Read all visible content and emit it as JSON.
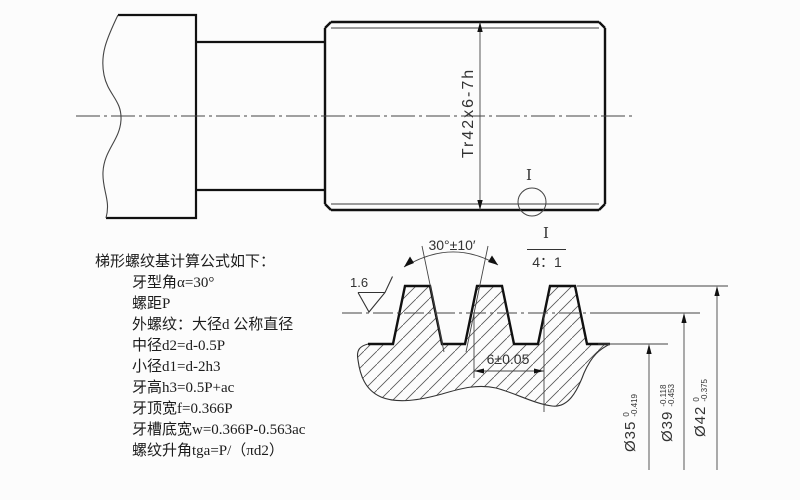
{
  "formulas": {
    "title": "梯形螺纹基计算公式如下：",
    "lines": [
      "牙型角α=30°",
      "螺距P",
      "外螺纹：大径d 公称直径",
      "中径d2=d-0.5P",
      "小径d1=d-2h3",
      "牙高h3=0.5P+ac",
      "牙顶宽f=0.366P",
      "牙槽底宽w=0.366P-0.563ac",
      "螺纹升角tga=P/（πd2）"
    ]
  },
  "main_view": {
    "thread_spec": "Tr42x6-7h",
    "detail_marker": "I"
  },
  "detail_view": {
    "detail_label": "I",
    "detail_scale": "4：1",
    "angle_dim": "30°±10′",
    "roughness": "1.6",
    "pitch_dim": "6±0.05",
    "diameters": [
      {
        "label": "Ø35",
        "upper_tol": "0",
        "lower_tol": "-0.419"
      },
      {
        "label": "Ø39",
        "upper_tol": "-0.118",
        "lower_tol": "-0.453"
      },
      {
        "label": "Ø42",
        "upper_tol": "0",
        "lower_tol": "-0.375"
      }
    ]
  }
}
